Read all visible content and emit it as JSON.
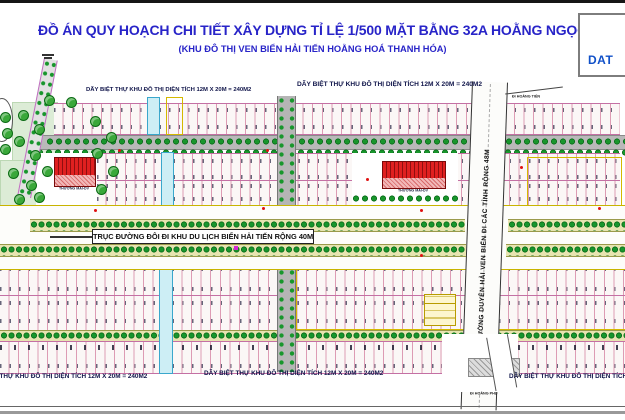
{
  "title": "ĐỒ ÁN QUY HOẠCH CHI TIẾT XÂY DỰNG TỈ LỆ 1/500 MẶT BẰNG 32A HOẰNG NGỌC",
  "subtitle": "(KHU ĐÔ THỊ VEN BIỂN HẢI TIẾN HOẰNG HOÁ THANH HÓA)",
  "logo": {
    "text": "DAT"
  },
  "map": {
    "villa_row_label": "DÃY BIỆT THỰ KHU ĐÔ THỊ DIỆN TÍCH 12M X 20M = 240M2",
    "main_road_label": "TRỤC ĐƯỜNG ĐÔI ĐI KHU DU LỊCH BIỂN HẢI TIẾN RỘNG 40M",
    "coastal_road_label": "ĐƯỜNG DUYÊN HẢI VEN BIỂN ĐI CÁC TỈNH RỘNG 48M",
    "commercial_label": "THƯƠNG MẠI-DV",
    "exit_north_label": "Đi HOẰNG TIẾN",
    "exit_south_label": "Đi HOẰNG PHỤ",
    "colors": {
      "title_blue": "#2824c8",
      "logo_blue": "#1050c8",
      "plot_line_pink": "#dd9cb4",
      "tree_green": "#18962c",
      "road_gray": "#b9b9b9",
      "building_red": "#e02020",
      "channel_cyan": "#cdeef5",
      "highlight_yellow": "#d4b800"
    }
  }
}
